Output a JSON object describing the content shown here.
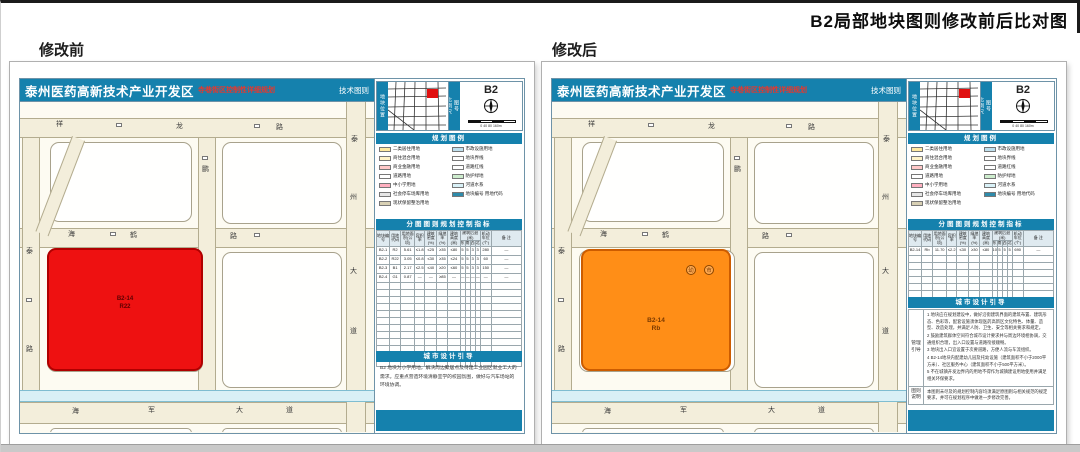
{
  "banner": {
    "title": "B2局部地块图则修改前后比对图"
  },
  "colors": {
    "teal": "#1581ad",
    "plot_before": "#ee1111",
    "plot_after": "#ff8e17",
    "road_fill": "#f3eedb",
    "canal": "#d9f0f6"
  },
  "shared": {
    "sheet": {
      "title": "泰州医药高新技术产业开发区",
      "subtitle": "寺巷街区控制性详细规划",
      "corner_label": "技术图则",
      "sheet_no": "B2"
    },
    "inset": {
      "left_strip": "地块位置",
      "mid_top": "图号",
      "mid_bottom": "比例尺",
      "scale_labels": "0 40 80 160m"
    },
    "legend": {
      "title": "规划图例",
      "left_items": [
        {
          "color": "#ffe9a0",
          "label": "二类居住用地"
        },
        {
          "color": "#fff3c8",
          "label": "商住混合用地"
        },
        {
          "color": "#ffc8c8",
          "label": "商业金融用地"
        },
        {
          "color": "#ffffff",
          "label": "道路用地"
        },
        {
          "color": "#ffb0c0",
          "label": "中小学用地"
        },
        {
          "color": "#e6e6e6",
          "label": "社会停车场库用地"
        },
        {
          "color": "#d8d0b4",
          "label": "现状保留整治用地"
        }
      ],
      "right_items": [
        {
          "color": "#bfe0ee",
          "label": "市政设施用地"
        },
        {
          "color": "#ffffff",
          "label": "地块界线"
        },
        {
          "color": "#ffffff",
          "label": "道路红线"
        },
        {
          "color": "#cdeccd",
          "label": "防护绿地"
        },
        {
          "color": "#d9f1f7",
          "label": "河道水系"
        },
        {
          "color": "#2e8bab",
          "label": "地块编号 用地代码"
        }
      ]
    },
    "table": {
      "title": "分图图则规划控制指标",
      "headers": [
        "地块编号",
        "用地代码",
        "用地面积(公顷)",
        "容积率",
        "建筑密度(%)",
        "绿地率(%)",
        "建筑高度(米)"
      ],
      "setback_group": "建筑后退(米)",
      "setback_subs": [
        "东",
        "南",
        "西",
        "北"
      ],
      "tail_headers": [
        "机动车位(个)",
        "备 注"
      ]
    },
    "roads": {
      "top": [
        "祥",
        "龙",
        "路"
      ],
      "middle": [
        "海",
        "鹤",
        "路"
      ],
      "bottom": [
        "海",
        "军",
        "大",
        "道"
      ],
      "right": [
        "泰",
        "州",
        "大",
        "道"
      ],
      "left": [
        "泰",
        "路"
      ],
      "mid_v": "鹏"
    },
    "notes_title": "城市设计引导"
  },
  "panels": [
    {
      "label": "修改前",
      "plot": {
        "code": "B2-14",
        "use": "R22"
      },
      "rows": [
        [
          "B2-1",
          "R2",
          "5.61",
          "≤1.8",
          "≤25",
          "≥35",
          "≤80",
          "5",
          "5",
          "3",
          "3",
          "280",
          "—"
        ],
        [
          "B2-2",
          "R22",
          "3.05",
          "≤0.8",
          "≤30",
          "≥35",
          "≤24",
          "5",
          "5",
          "3",
          "3",
          "60",
          "—"
        ],
        [
          "B2-3",
          "B1",
          "2.17",
          "≤2.5",
          "≤40",
          "≥20",
          "≤60",
          "5",
          "5",
          "3",
          "3",
          "150",
          "—"
        ],
        [
          "B2-4",
          "G1",
          "0.87",
          "—",
          "—",
          "≥85",
          "—",
          "—",
          "—",
          "—",
          "—",
          "—",
          "—"
        ]
      ],
      "empty_rows": 12,
      "notes_text": "B2 地块为小学用地，解决周边聚居点及待建工业园区就业工人的需求。应重点营造环境清静宜学的校园氛围，做好与汽车场站的环境协调。"
    },
    {
      "label": "修改后",
      "plot": {
        "code": "B2-14",
        "use": "Rb",
        "symbols": [
          "幼",
          "市"
        ]
      },
      "rows": [
        [
          "B2-14",
          "Rb",
          "11.70",
          "≤2.2",
          "≤30",
          "≥30",
          "≤80",
          "10",
          "5",
          "5",
          "5",
          "690",
          "—"
        ]
      ],
      "empty_rows": 7,
      "notes_side1": "管理 引导",
      "notes_items": [
        "地块应在规划建设中，做好沿街建筑界面的建筑布置、建筑形态、色彩等，配套设施须体现医药高新区文化特色、体量、造型、改造处理，并满足人防、卫生、安全等相关要求和规定。",
        "鼓励建筑群体空间符合城市设计要求并与周边环境相协调，交通组织合理，出入口设置与道路衔接顺畅。",
        "地块出入口宜设置于次要道路，方便人流与车流组织。",
        "B2-14地块内配建幼儿园及托幼设施（建筑面积不小于2000平方米）、社区服务中心（建筑面积不小于500平方米）。",
        "不在城镇开发边界内的用地不得作为城镇建设用地使用并满足相关环保要求。"
      ],
      "notes_side2": "图则 说明",
      "notes_note2": "本图则未尽及的规划控制内容均须满足原图则与相关规范的规定要求，并可在规划程序中做进一步修改完善。"
    }
  ]
}
